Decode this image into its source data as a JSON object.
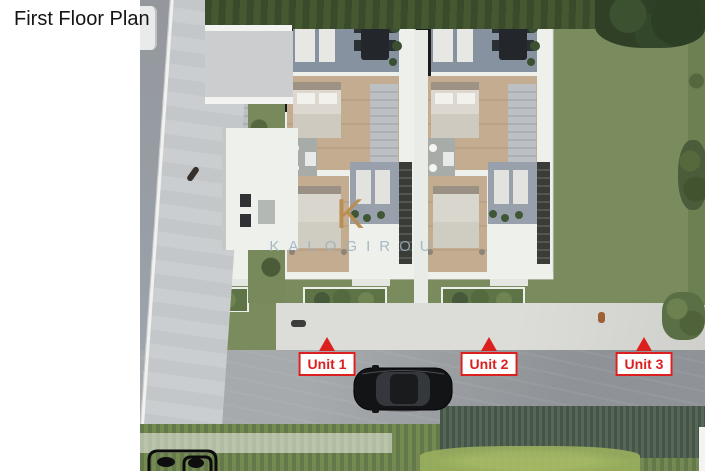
{
  "page": {
    "title": "First Floor Plan"
  },
  "watermark": {
    "logo_letter": "K",
    "brand": "KALOGIROU"
  },
  "units": [
    {
      "label": "Unit 1"
    },
    {
      "label": "Unit 2"
    },
    {
      "label": "Unit 3"
    }
  ],
  "icons": {
    "unit-marker-arrow-icon": "triangle-up",
    "car-top-view-icon": "black-sedan-roof-view",
    "parked-car-icon": "white-car-partial",
    "person-icon": "pedestrian-dot",
    "partial-badge-icon": "cropped-black-outline-logo",
    "brand-k-icon": "letter-K-monogram"
  },
  "colors": {
    "label_red": "#dc1f1f",
    "watermark_gold": "#b98d4f",
    "watermark_gray": "#9cb0bd",
    "roof_blue": "#8792a1",
    "roof_light": "#aeb6bf",
    "wood": "#c3ac8f",
    "grass": "#7a8b5e",
    "hedge": "#41522f",
    "road": "#a2a6a9",
    "sidewalk": "#c6c9cb",
    "walkway": "#d9dad6"
  }
}
